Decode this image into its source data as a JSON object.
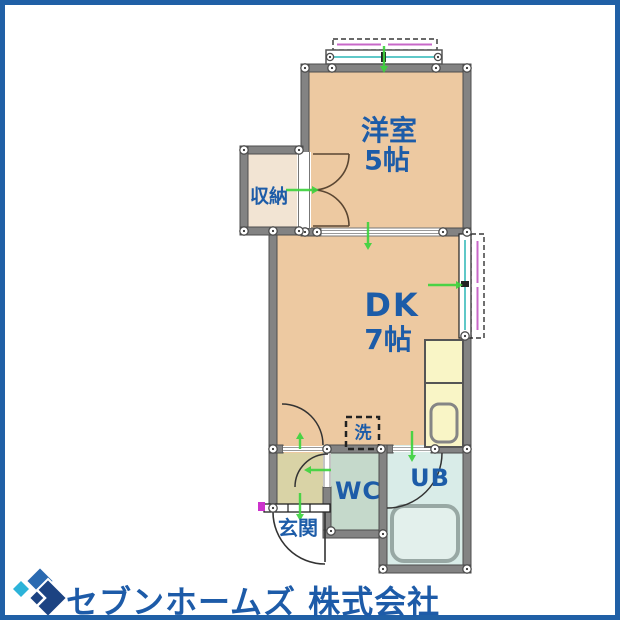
{
  "frame": {
    "border_color": "#2060a6"
  },
  "floorplan": {
    "rooms": {
      "western": {
        "name": "洋室",
        "size": "5帖"
      },
      "dk": {
        "name": "DK",
        "size": "7帖"
      },
      "closet": {
        "name": "収納"
      },
      "washer": {
        "name": "洗"
      },
      "wc": {
        "name": "WC"
      },
      "bath": {
        "name": "UB"
      },
      "entrance": {
        "name": "玄関"
      }
    },
    "colors": {
      "room_fill": "#edc9a1",
      "closet_fill": "#f2e4d3",
      "entrance_fill": "#d9d3a6",
      "wc_fill": "#c5d9cb",
      "bath_fill": "#d9ece8",
      "kitchen_fill": "#f9f5c6",
      "wall_gray": "#838383",
      "label_blue": "#1d5ca8",
      "arrow_green": "#3ed33e",
      "window_cyan": "#5fc8c8",
      "sash_magenta": "#c868c8"
    }
  },
  "footer": {
    "company_name": "セブンホームズ 株式会社",
    "logo_colors": {
      "navy": "#1c4382",
      "blue": "#2a69b0",
      "cyan": "#2cb3d9"
    }
  }
}
